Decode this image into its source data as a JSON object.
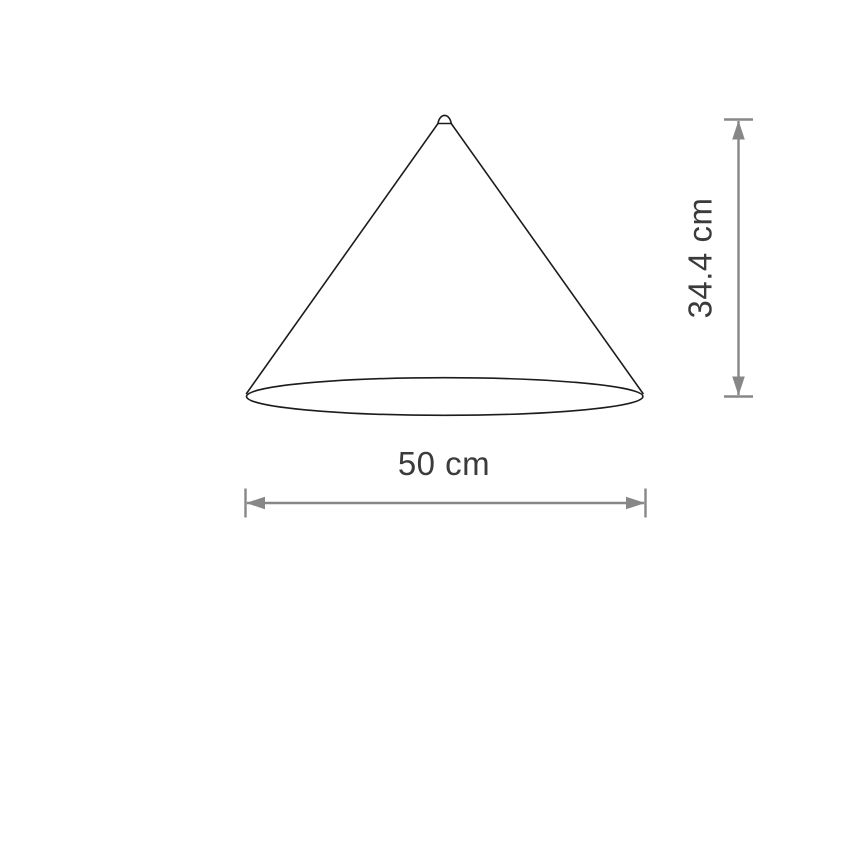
{
  "diagram": {
    "height_dimension": {
      "label": "34.4 cm"
    },
    "width_dimension": {
      "label": "50 cm"
    },
    "colors": {
      "outline": "#1c1c1c",
      "dimension_line": "#878787",
      "label_text": "#3b3b3a",
      "background": "#ffffff"
    }
  }
}
